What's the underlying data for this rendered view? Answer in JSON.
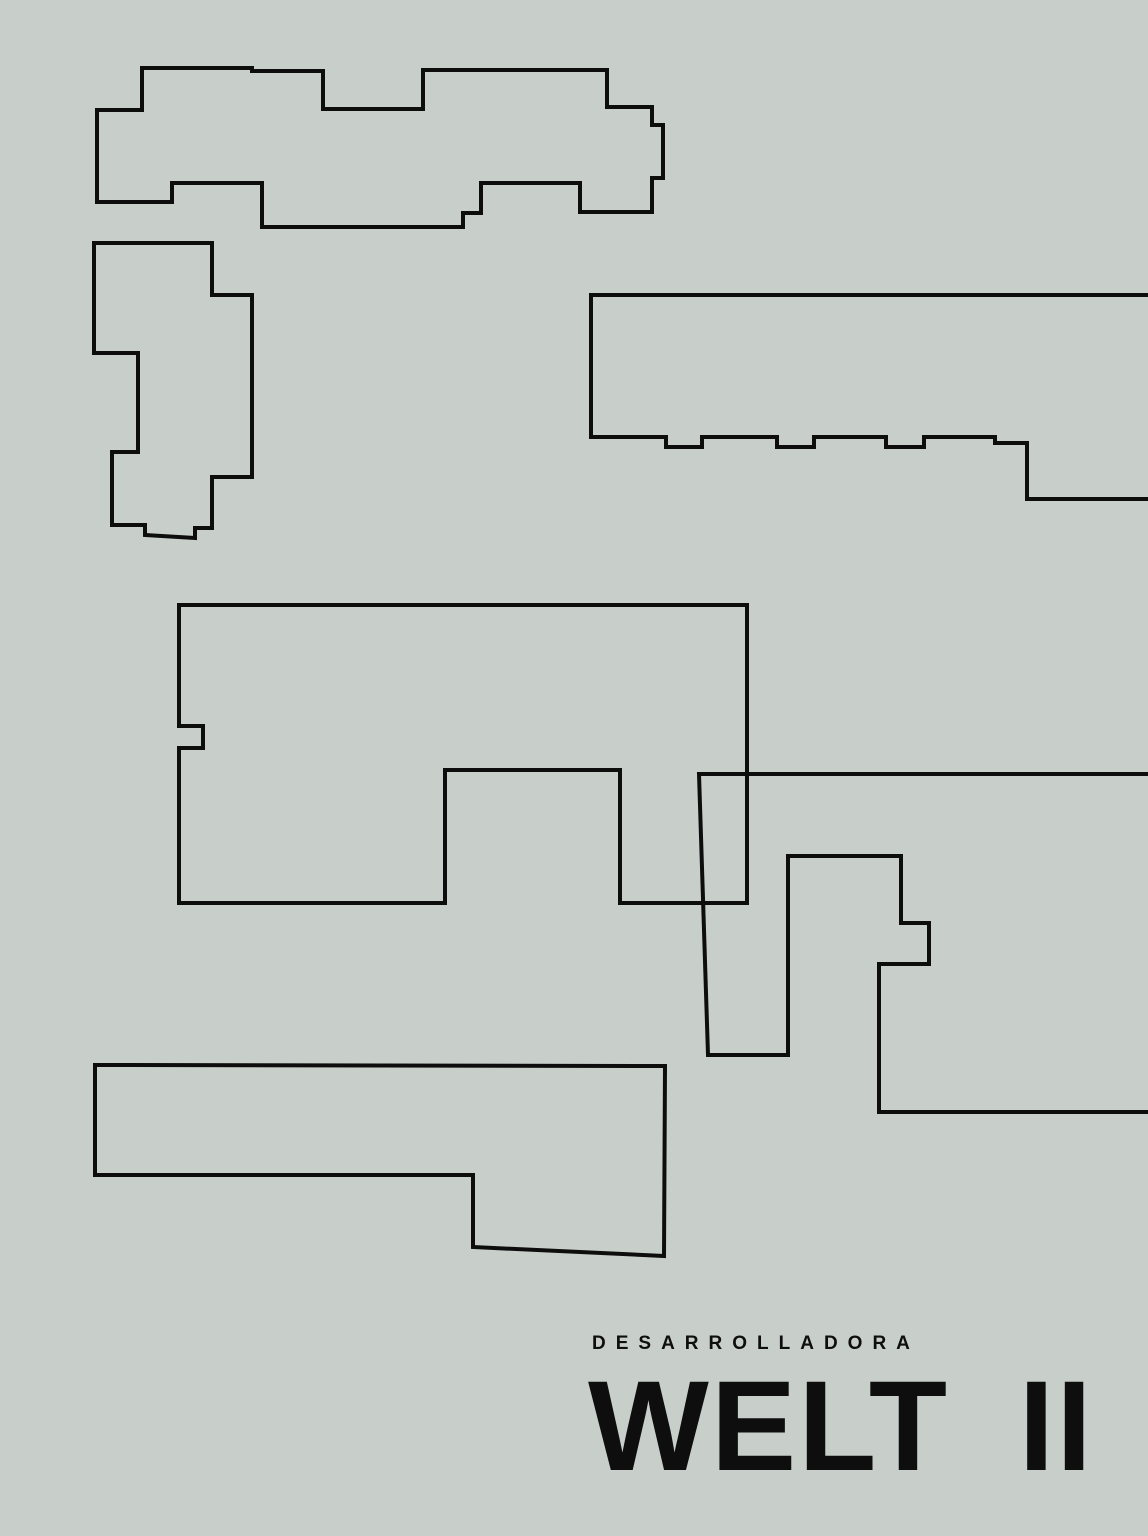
{
  "poster": {
    "eyebrow": "DESARROLLADORA",
    "title": "WELT II",
    "background_color": "#c8cfcb",
    "line_color": "#0d0d0d",
    "text_color": "#0e0e0e"
  },
  "canvas": {
    "width": 1148,
    "height": 1536
  },
  "shapes": [
    {
      "name": "building-outline-top-left",
      "type": "polygon",
      "points": [
        [
          142,
          68
        ],
        [
          252,
          68
        ],
        [
          252,
          71
        ],
        [
          323,
          71
        ],
        [
          323,
          109
        ],
        [
          423,
          109
        ],
        [
          423,
          70
        ],
        [
          607,
          70
        ],
        [
          607,
          107
        ],
        [
          652,
          107
        ],
        [
          652,
          125
        ],
        [
          663,
          125
        ],
        [
          663,
          178
        ],
        [
          652,
          178
        ],
        [
          652,
          212
        ],
        [
          580,
          212
        ],
        [
          580,
          183
        ],
        [
          481,
          183
        ],
        [
          481,
          213
        ],
        [
          463,
          213
        ],
        [
          463,
          227
        ],
        [
          262,
          227
        ],
        [
          262,
          183
        ],
        [
          172,
          183
        ],
        [
          172,
          202
        ],
        [
          97,
          202
        ],
        [
          97,
          110
        ],
        [
          142,
          110
        ]
      ]
    },
    {
      "name": "building-outline-left",
      "type": "polygon",
      "points": [
        [
          94,
          243
        ],
        [
          212,
          243
        ],
        [
          212,
          295
        ],
        [
          252,
          295
        ],
        [
          252,
          477
        ],
        [
          212,
          477
        ],
        [
          212,
          528
        ],
        [
          195,
          528
        ],
        [
          195,
          538
        ],
        [
          145,
          535
        ],
        [
          145,
          525
        ],
        [
          112,
          525
        ],
        [
          112,
          452
        ],
        [
          138,
          452
        ],
        [
          138,
          353
        ],
        [
          94,
          353
        ]
      ]
    },
    {
      "name": "building-outline-top-right",
      "type": "polygon",
      "points": [
        [
          591,
          295
        ],
        [
          1160,
          295
        ],
        [
          1160,
          499
        ],
        [
          1027,
          499
        ],
        [
          1027,
          443
        ],
        [
          995,
          443
        ],
        [
          995,
          437
        ],
        [
          924,
          437
        ],
        [
          924,
          447
        ],
        [
          886,
          447
        ],
        [
          886,
          437
        ],
        [
          814,
          437
        ],
        [
          814,
          447
        ],
        [
          777,
          447
        ],
        [
          777,
          437
        ],
        [
          702,
          437
        ],
        [
          702,
          447
        ],
        [
          666,
          447
        ],
        [
          666,
          437
        ],
        [
          591,
          437
        ]
      ]
    },
    {
      "name": "building-outline-center",
      "type": "polygon",
      "points": [
        [
          179,
          605
        ],
        [
          747,
          605
        ],
        [
          747,
          903
        ],
        [
          620,
          903
        ],
        [
          620,
          770
        ],
        [
          445,
          770
        ],
        [
          445,
          903
        ],
        [
          179,
          903
        ],
        [
          179,
          748
        ],
        [
          203,
          748
        ],
        [
          203,
          726
        ],
        [
          179,
          726
        ]
      ]
    },
    {
      "name": "building-outline-right-hook",
      "type": "polyline",
      "points": [
        [
          1160,
          774
        ],
        [
          699,
          774
        ],
        [
          708,
          1055
        ],
        [
          788,
          1055
        ],
        [
          788,
          856
        ],
        [
          901,
          856
        ],
        [
          901,
          923
        ],
        [
          929,
          923
        ],
        [
          929,
          964
        ],
        [
          879,
          964
        ],
        [
          879,
          1112
        ],
        [
          1160,
          1112
        ]
      ]
    },
    {
      "name": "building-outline-bottom-left",
      "type": "polygon",
      "points": [
        [
          95,
          1065
        ],
        [
          665,
          1066
        ],
        [
          664,
          1256
        ],
        [
          473,
          1247
        ],
        [
          473,
          1175
        ],
        [
          95,
          1175
        ]
      ]
    }
  ]
}
